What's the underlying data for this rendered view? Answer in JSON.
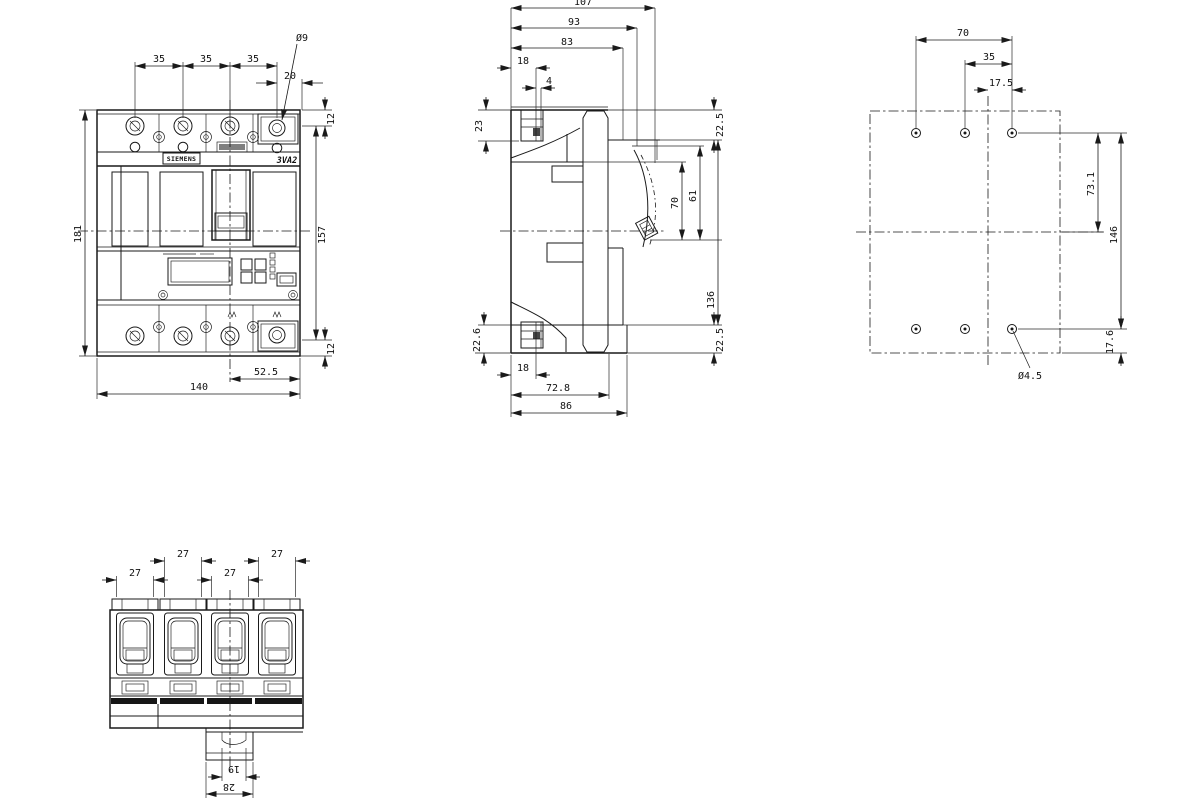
{
  "views": {
    "front": {
      "brand": "SIEMENS",
      "model": "3VA2",
      "dims": {
        "p12": "35",
        "p23": "35",
        "p34": "35",
        "edge": "20",
        "hole": "Ø9",
        "pad_top": "12",
        "inner_h": "157",
        "pad_bot": "12",
        "total_h": "181",
        "half_w": "52.5",
        "total_w": "140"
      }
    },
    "side": {
      "dims": {
        "d107": "107",
        "d93": "93",
        "d83": "83",
        "d18t": "18",
        "d4": "4",
        "d23": "23",
        "d225t": "22.5",
        "d70": "70",
        "d61": "61",
        "d136": "136",
        "d226": "22.6",
        "d225b": "22.5",
        "d18b": "18",
        "d728": "72.8",
        "d86": "86"
      }
    },
    "drilling": {
      "dims": {
        "w70": "70",
        "w35": "35",
        "w175": "17.5",
        "h731": "73.1",
        "h146": "146",
        "h176": "17.6",
        "dia": "Ø4.5"
      }
    },
    "bottom": {
      "dims": {
        "c1": "27",
        "c2": "27",
        "c3": "27",
        "c4": "27",
        "clip_in": "19",
        "clip_out": "28"
      }
    }
  }
}
